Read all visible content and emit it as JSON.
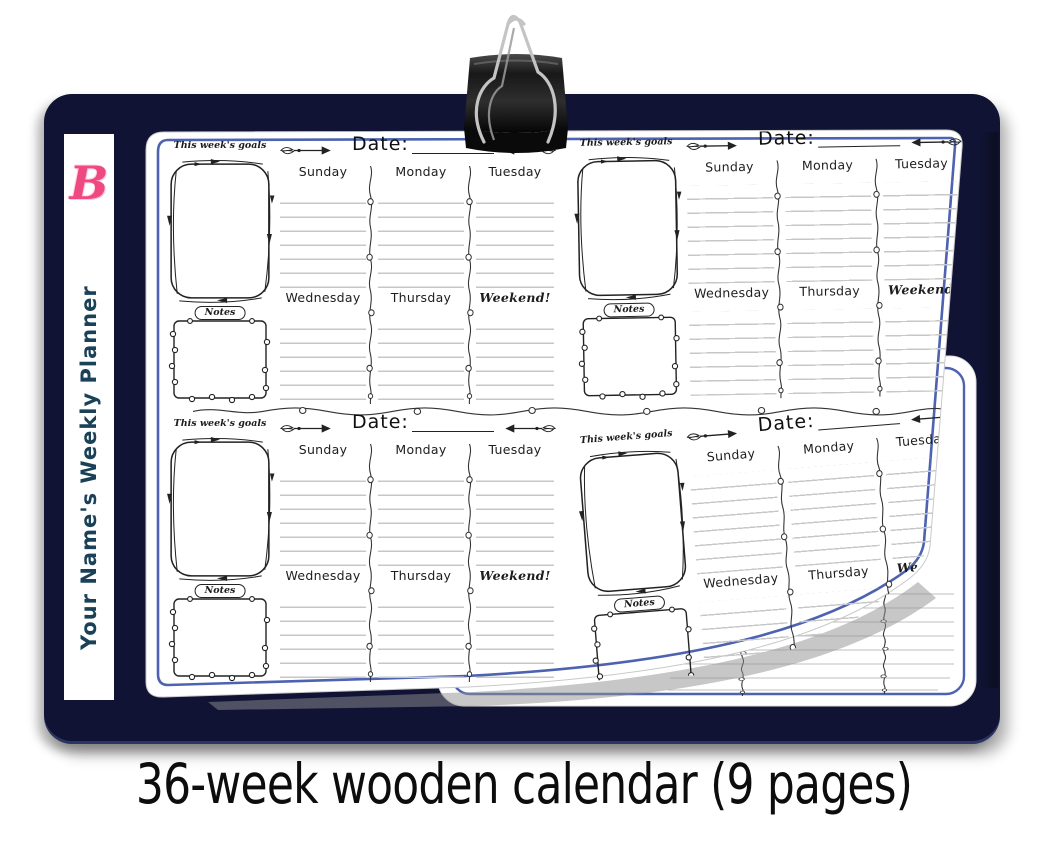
{
  "caption": "36-week wooden calendar (9 pages)",
  "spine": {
    "logo_letter": "B",
    "title": "Your Name's Weekly Planner"
  },
  "week_block": {
    "goals_label": "This week's goals",
    "date_label": "Date:",
    "days_row1": [
      "Sunday",
      "Monday",
      "Tuesday"
    ],
    "days_row2": [
      "Wednesday",
      "Thursday",
      "Weekend!"
    ],
    "notes_label": "Notes"
  },
  "page": {
    "weeks_visible_per_page": 4
  },
  "icons": {
    "binder_clip": "binder-clip-icon",
    "arrow_right": "feather-arrow-right-icon",
    "arrow_left": "feather-arrow-left-icon"
  },
  "colors": {
    "board_navy": "#101334",
    "page_border_blue": "#4d62b0",
    "logo_pink": "#ee4a81",
    "spine_text": "#1a4157",
    "ink": "#222222",
    "ruled_line": "#c7c7c7"
  }
}
